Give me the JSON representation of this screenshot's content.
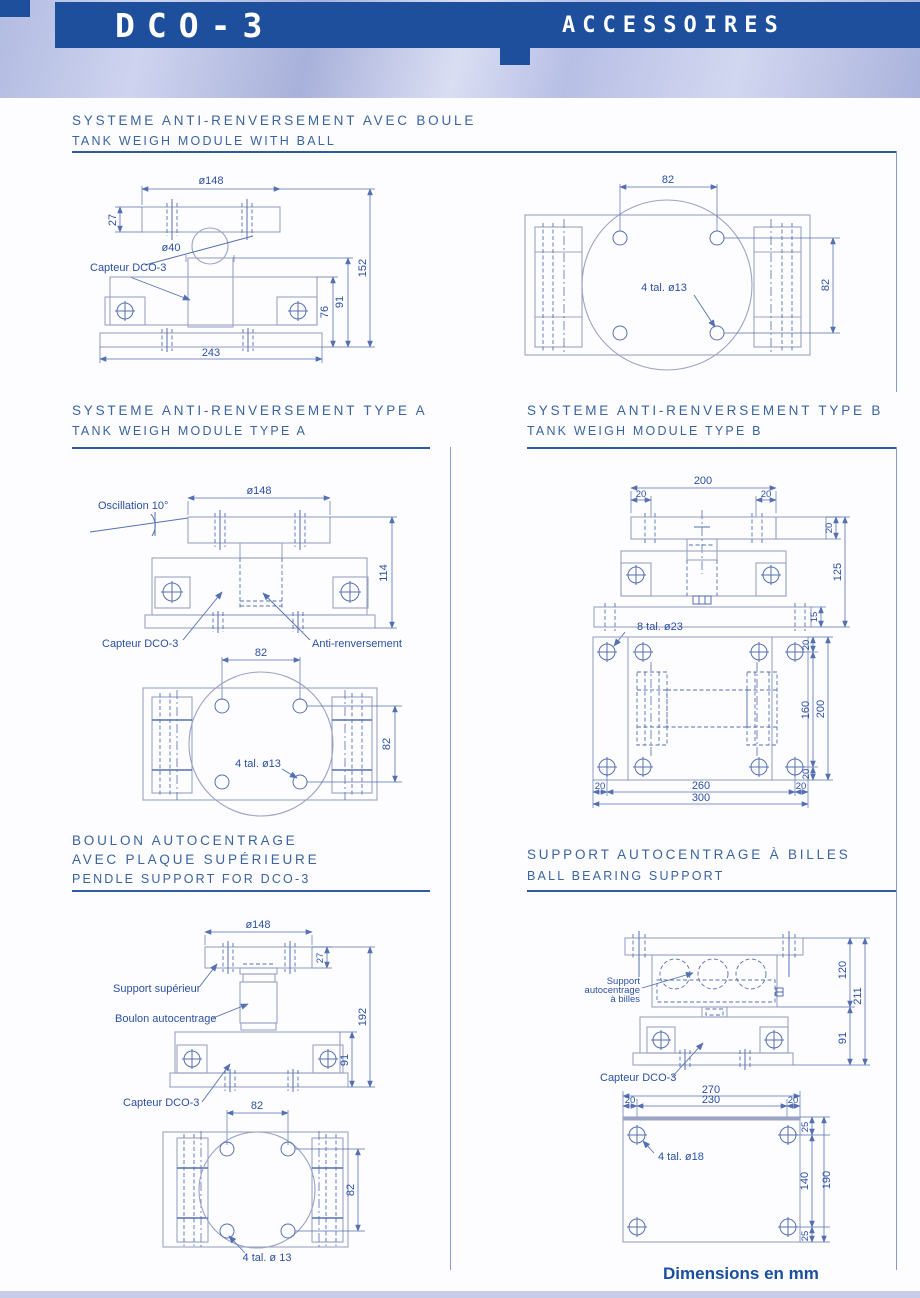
{
  "header": {
    "product": "DCO-3",
    "page_title": "ACCESSOIRES"
  },
  "sections": {
    "ball": {
      "title_fr": "SYSTEME ANTI-RENVERSEMENT AVEC BOULE",
      "title_en": "TANK WEIGH MODULE WITH BALL"
    },
    "type_a": {
      "title_fr": "SYSTEME ANTI-RENVERSEMENT TYPE A",
      "title_en": "TANK WEIGH MODULE TYPE A"
    },
    "type_b": {
      "title_fr": "SYSTEME ANTI-RENVERSEMENT TYPE B",
      "title_en": "TANK WEIGH MODULE TYPE B"
    },
    "pendle": {
      "title_fr_line1": "BOULON AUTOCENTRAGE",
      "title_fr_line2": "AVEC PLAQUE SUPÉRIEURE",
      "title_en": "PENDLE SUPPORT FOR DCO-3"
    },
    "ball_bearing": {
      "title_fr": "SUPPORT AUTOCENTRAGE À BILLES",
      "title_en": "BALL BEARING SUPPORT"
    }
  },
  "labels": {
    "capteur": "Capteur DCO-3",
    "oscillation": "Oscillation 10°",
    "anti_renversement": "Anti-renversement",
    "support_superieur": "Support supérieur",
    "boulon_autocentrage": "Boulon autocentrage",
    "support_billes_1": "Support",
    "support_billes_2": "autocentrage",
    "support_billes_3": "à billes"
  },
  "dims": {
    "ball_side": {
      "dia_plate": "ø148",
      "plate_h": "27",
      "ball_dia": "ø40",
      "total_h": "152",
      "h91": "91",
      "h76": "76",
      "base_w": "243"
    },
    "ball_top": {
      "hole_x": "82",
      "hole_y": "82",
      "holes": "4 tal. ø13"
    },
    "type_a_side": {
      "dia_plate": "ø148",
      "total_h": "114"
    },
    "type_a_top": {
      "hole_x": "82",
      "hole_y": "82",
      "holes": "4 tal. ø13"
    },
    "type_b_side": {
      "plate_w": "200",
      "inset_l": "20",
      "inset_r": "20",
      "plate_h": "20",
      "total_h": "125",
      "base_h": "15"
    },
    "type_b_top": {
      "holes": "8 tal. ø23",
      "edge_t": "20",
      "hole_y": "160",
      "plate_l": "200",
      "edge_b": "20",
      "edge_l": "20",
      "hole_x": "260",
      "edge_r": "20",
      "plate_w": "300"
    },
    "pendle_side": {
      "dia_plate": "ø148",
      "plate_h": "27",
      "total_h": "192",
      "body_h": "91"
    },
    "pendle_top": {
      "hole_x": "82",
      "hole_y": "82",
      "holes": "4 tal. ø 13"
    },
    "ball_bearing_side": {
      "support_h": "120",
      "total_h": "211",
      "body_h": "91"
    },
    "ball_bearing_top": {
      "plate_w": "270",
      "hole_x_total": "230",
      "edge_l": "20",
      "edge_r": "20",
      "edge_t": "25",
      "hole_y": "140",
      "plate_h": "190",
      "edge_b": "25",
      "holes": "4 tal. ø18"
    }
  },
  "footer": {
    "note": "Dimensions en mm"
  },
  "colors": {
    "band_blue": "#1d4f9c",
    "title_blue": "#3a64a0",
    "line_blue": "#5570b2",
    "outline_gray": "#9aa3c4",
    "text_blue": "#2b50a2"
  }
}
